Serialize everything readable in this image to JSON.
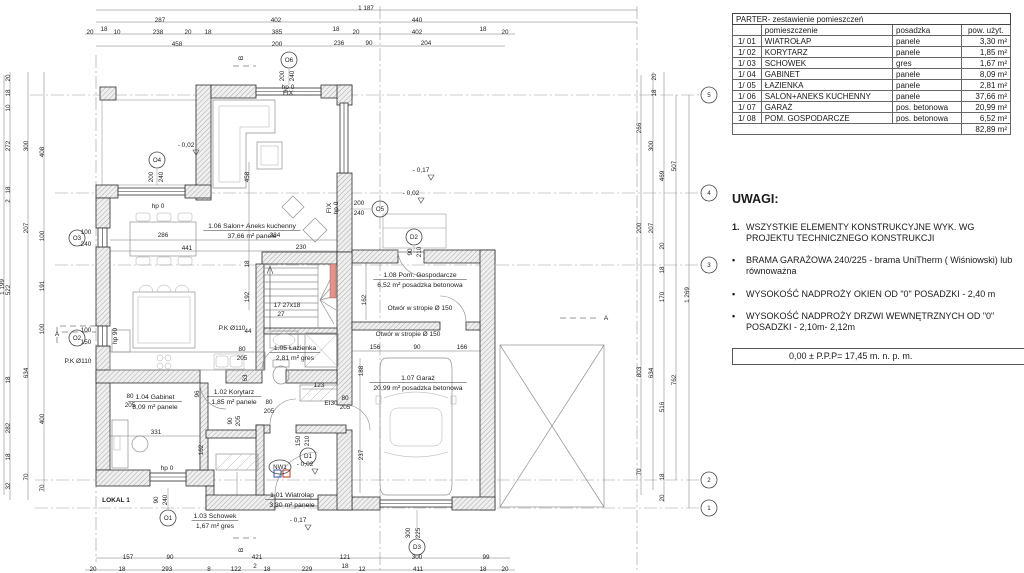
{
  "table": {
    "title": "PARTER- zestawienie pomieszczeń",
    "headers": [
      "",
      "pomieszczenie",
      "posadzka",
      "pow. użyt."
    ],
    "rows": [
      [
        "1/ 01",
        "WIATROŁAP",
        "panele",
        "3,30 m²"
      ],
      [
        "1/ 02",
        "KORYTARZ",
        "panele",
        "1,85 m²"
      ],
      [
        "1/ 03",
        "SCHOWEK",
        "gres",
        "1,67 m²"
      ],
      [
        "1/ 04",
        "GABINET",
        "panele",
        "8,09 m²"
      ],
      [
        "1/ 05",
        "ŁAZIENKA",
        "panele",
        "2,81 m²"
      ],
      [
        "1/ 06",
        "SALON+ANEKS KUCHENNY",
        "panele",
        "37,66 m²"
      ],
      [
        "1/ 07",
        "GARAŻ",
        "pos. betonowa",
        "20,99 m²"
      ],
      [
        "1/ 08",
        "POM. GOSPODARCZE",
        "pos. betonowa",
        "6,52 m²"
      ]
    ],
    "total": "82,89 m²"
  },
  "uwagi": {
    "heading": "UWAGI:",
    "item1_marker": "1.",
    "item1": "WSZYSTKIE ELEMENTY KONSTRUKCYJNE  WYK. WG PROJEKTU TECHNICZNEGO KONSTRUKCJI",
    "bullet_marker": "•",
    "bullets": [
      "BRAMA GARAŻOWA 240/225 - brama UniTherm ( Wiśniowski) lub równoważna",
      "WYSOKOŚĆ NADPROŻY OKIEN OD \"0\" POSADZKI - 2,40 m",
      "WYSOKOŚĆ NADPROŻY DRZWI WEWNĘTRZNYCH OD \"0\" POSADZKI - 2,10m- 2,12m"
    ],
    "level_box": "0,00 ± P.P.P= 17,45 m. n. p. m."
  },
  "plan": {
    "rooms": [
      {
        "num": "1.06",
        "name": "Salon+ Aneks kuchenny",
        "area": "37,66 m²",
        "floor": "panele",
        "x": 252,
        "y": 228
      },
      {
        "num": "1.08",
        "name": "Pom. Gospodarcze",
        "area": "6,52 m²",
        "floor": "posadzka betonowa",
        "x": 420,
        "y": 277
      },
      {
        "num": "1.07",
        "name": "Garaż",
        "area": "20,99 m²",
        "floor": "posadzka betonowa",
        "x": 418,
        "y": 380
      },
      {
        "num": "1.05",
        "name": "Łazienka",
        "area": "2,81 m²",
        "floor": "gres",
        "x": 295,
        "y": 350
      },
      {
        "num": "1.02",
        "name": "Korytarz",
        "area": "1,85 m²",
        "floor": "panele",
        "x": 234,
        "y": 394
      },
      {
        "num": "1.04",
        "name": "Gabinet",
        "area": "8,09 m²",
        "floor": "panele",
        "x": 155,
        "y": 399
      },
      {
        "num": "1.01",
        "name": "Wiatrołap",
        "area": "3,30 m²",
        "floor": "panele",
        "x": 292,
        "y": 497
      },
      {
        "num": "1.03",
        "name": "Schowek",
        "area": "1,67 m²",
        "floor": "gres",
        "x": 215,
        "y": 518
      }
    ],
    "tags": [
      {
        "t": "O6",
        "x": 289,
        "y": 60
      },
      {
        "t": "O4",
        "x": 157,
        "y": 160
      },
      {
        "t": "O3",
        "x": 77,
        "y": 238
      },
      {
        "t": "O2",
        "x": 77,
        "y": 338
      },
      {
        "t": "O1",
        "x": 168,
        "y": 518
      },
      {
        "t": "O5",
        "x": 380,
        "y": 209
      },
      {
        "t": "D2",
        "x": 414,
        "y": 237
      },
      {
        "t": "D1",
        "x": 308,
        "y": 456
      },
      {
        "t": "D3",
        "x": 417,
        "y": 547
      },
      {
        "t": "NW1",
        "x": 280,
        "y": 467,
        "w": 1
      },
      {
        "t": "5",
        "x": 709,
        "y": 95
      },
      {
        "t": "4",
        "x": 709,
        "y": 193
      },
      {
        "t": "3",
        "x": 709,
        "y": 265
      },
      {
        "t": "2",
        "x": 709,
        "y": 480
      },
      {
        "t": "1",
        "x": 709,
        "y": 508
      }
    ],
    "notes": [
      {
        "t": "hp 0",
        "x": 288,
        "y": 89
      },
      {
        "t": "FIX",
        "x": 288,
        "y": 95,
        "s": 4.5
      },
      {
        "t": "hp 0",
        "x": 158,
        "y": 208
      },
      {
        "t": "hp 0",
        "x": 167,
        "y": 470
      },
      {
        "t": "hp 0",
        "x": 338,
        "y": 208,
        "r": -90,
        "s": 5.5
      },
      {
        "t": "FIX",
        "x": 331,
        "y": 208,
        "r": -90,
        "s": 4.5
      },
      {
        "t": "hp 90",
        "x": 117,
        "y": 336,
        "r": -90,
        "s": 5.5
      },
      {
        "t": "- 0,02",
        "x": 186,
        "y": 147
      },
      {
        "t": "- 0,17",
        "x": 421,
        "y": 172
      },
      {
        "t": "- 0,02",
        "x": 411,
        "y": 195
      },
      {
        "t": "- 0,02",
        "x": 305,
        "y": 466
      },
      {
        "t": "- 0,17",
        "x": 298,
        "y": 522
      },
      {
        "t": "P.K Ø110",
        "x": 78,
        "y": 363,
        "s": 6
      },
      {
        "t": "P.K Ø110",
        "x": 232,
        "y": 330,
        "s": 6.5
      },
      {
        "t": "Otwór w stropie Ø 150",
        "x": 420,
        "y": 310
      },
      {
        "t": "Otwór w stropie Ø 150",
        "x": 408,
        "y": 336
      },
      {
        "t": "EI30",
        "x": 331,
        "y": 405
      },
      {
        "t": "17 27x18",
        "x": 287,
        "y": 307
      },
      {
        "t": "27",
        "x": 281,
        "y": 316
      },
      {
        "t": "LOKAL 1",
        "x": 116,
        "y": 502,
        "b": 1,
        "s": 7.5
      },
      {
        "t": "A",
        "x": 57,
        "y": 336,
        "s": 14
      },
      {
        "t": "A",
        "x": 606,
        "y": 320,
        "s": 14
      },
      {
        "t": "B",
        "x": 243,
        "y": 58,
        "s": 14,
        "r": -90
      },
      {
        "t": "B",
        "x": 243,
        "y": 550,
        "s": 14,
        "r": -90
      }
    ],
    "dims": [
      {
        "t": "1 187",
        "x": 366,
        "y": 10
      },
      {
        "t": "287",
        "x": 160,
        "y": 22
      },
      {
        "t": "402",
        "x": 276,
        "y": 22
      },
      {
        "t": "440",
        "x": 417,
        "y": 22
      },
      {
        "t": "20",
        "x": 90,
        "y": 34
      },
      {
        "t": "18",
        "x": 104,
        "y": 31
      },
      {
        "t": "10",
        "x": 117,
        "y": 34
      },
      {
        "t": "238",
        "x": 158,
        "y": 34
      },
      {
        "t": "20",
        "x": 188,
        "y": 34
      },
      {
        "t": "18",
        "x": 208,
        "y": 34
      },
      {
        "t": "385",
        "x": 277,
        "y": 34
      },
      {
        "t": "18",
        "x": 336,
        "y": 31
      },
      {
        "t": "20",
        "x": 356,
        "y": 34
      },
      {
        "t": "402",
        "x": 417,
        "y": 34
      },
      {
        "t": "18",
        "x": 483,
        "y": 31
      },
      {
        "t": "20",
        "x": 505,
        "y": 34
      },
      {
        "t": "458",
        "x": 177,
        "y": 46
      },
      {
        "t": "200",
        "x": 277,
        "y": 46
      },
      {
        "t": "236",
        "x": 339,
        "y": 45
      },
      {
        "t": "90",
        "x": 369,
        "y": 45
      },
      {
        "t": "204",
        "x": 426,
        "y": 45
      },
      {
        "t": "157",
        "x": 128,
        "y": 559
      },
      {
        "t": "90",
        "x": 170,
        "y": 559
      },
      {
        "t": "421",
        "x": 257,
        "y": 559
      },
      {
        "t": "121",
        "x": 345,
        "y": 559
      },
      {
        "t": "300",
        "x": 417,
        "y": 559
      },
      {
        "t": "99",
        "x": 486,
        "y": 559
      },
      {
        "t": "20",
        "x": 93,
        "y": 571
      },
      {
        "t": "18",
        "x": 122,
        "y": 571
      },
      {
        "t": "293",
        "x": 167,
        "y": 571
      },
      {
        "t": "8",
        "x": 209,
        "y": 571
      },
      {
        "t": "122",
        "x": 236,
        "y": 571
      },
      {
        "t": "2",
        "x": 255,
        "y": 568
      },
      {
        "t": "18",
        "x": 267,
        "y": 571
      },
      {
        "t": "229",
        "x": 307,
        "y": 571
      },
      {
        "t": "18",
        "x": 345,
        "y": 568
      },
      {
        "t": "12",
        "x": 362,
        "y": 571
      },
      {
        "t": "411",
        "x": 418,
        "y": 571
      },
      {
        "t": "18",
        "x": 483,
        "y": 571
      },
      {
        "t": "20",
        "x": 505,
        "y": 571
      },
      {
        "t": "1 199",
        "x": 4,
        "y": 287,
        "r": -90
      },
      {
        "t": "20",
        "x": 10,
        "y": 78,
        "r": -90
      },
      {
        "t": "18",
        "x": 10,
        "y": 93,
        "r": -90
      },
      {
        "t": "10",
        "x": 10,
        "y": 108,
        "r": -90
      },
      {
        "t": "272",
        "x": 10,
        "y": 146,
        "r": -90
      },
      {
        "t": "18",
        "x": 10,
        "y": 190,
        "r": -90
      },
      {
        "t": "2",
        "x": 10,
        "y": 201,
        "r": -90
      },
      {
        "t": "522",
        "x": 10,
        "y": 290,
        "r": -90
      },
      {
        "t": "18",
        "x": 10,
        "y": 380,
        "r": -90
      },
      {
        "t": "282",
        "x": 10,
        "y": 428,
        "r": -90
      },
      {
        "t": "18",
        "x": 10,
        "y": 457,
        "r": -90
      },
      {
        "t": "32",
        "x": 10,
        "y": 486,
        "r": -90
      },
      {
        "t": "300",
        "x": 28,
        "y": 146,
        "r": -90
      },
      {
        "t": "207",
        "x": 28,
        "y": 228,
        "r": -90
      },
      {
        "t": "634",
        "x": 28,
        "y": 373,
        "r": -90
      },
      {
        "t": "70",
        "x": 28,
        "y": 477,
        "r": -90
      },
      {
        "t": "408",
        "x": 44,
        "y": 152,
        "r": -90
      },
      {
        "t": "100",
        "x": 44,
        "y": 236,
        "r": -90
      },
      {
        "t": "191",
        "x": 44,
        "y": 286,
        "r": -90
      },
      {
        "t": "100",
        "x": 44,
        "y": 329,
        "r": -90
      },
      {
        "t": "400",
        "x": 44,
        "y": 419,
        "r": -90
      },
      {
        "t": "70",
        "x": 44,
        "y": 488,
        "r": -90
      },
      {
        "t": "266",
        "x": 641,
        "y": 128,
        "r": -90
      },
      {
        "t": "200",
        "x": 641,
        "y": 228,
        "r": -90
      },
      {
        "t": "803",
        "x": 641,
        "y": 372,
        "r": -90
      },
      {
        "t": "70",
        "x": 641,
        "y": 472,
        "r": -90
      },
      {
        "t": "300",
        "x": 653,
        "y": 146,
        "r": -90
      },
      {
        "t": "207",
        "x": 653,
        "y": 228,
        "r": -90
      },
      {
        "t": "634",
        "x": 653,
        "y": 373,
        "r": -90
      },
      {
        "t": "20",
        "x": 656,
        "y": 77,
        "r": -90
      },
      {
        "t": "18",
        "x": 656,
        "y": 93,
        "r": -90
      },
      {
        "t": "469",
        "x": 664,
        "y": 176,
        "r": -90
      },
      {
        "t": "20",
        "x": 664,
        "y": 246,
        "r": -90
      },
      {
        "t": "18",
        "x": 664,
        "y": 270,
        "r": -90
      },
      {
        "t": "170",
        "x": 664,
        "y": 297,
        "r": -90
      },
      {
        "t": "516",
        "x": 664,
        "y": 407,
        "r": -90
      },
      {
        "t": "18",
        "x": 664,
        "y": 477,
        "r": -90
      },
      {
        "t": "20",
        "x": 664,
        "y": 498,
        "r": -90
      },
      {
        "t": "507",
        "x": 676,
        "y": 166,
        "r": -90
      },
      {
        "t": "762",
        "x": 676,
        "y": 380,
        "r": -90
      },
      {
        "t": "1 269",
        "x": 689,
        "y": 295,
        "r": -90
      },
      {
        "t": "286",
        "x": 163,
        "y": 237
      },
      {
        "t": "441",
        "x": 187,
        "y": 250
      },
      {
        "t": "384",
        "x": 275,
        "y": 237
      },
      {
        "t": "230",
        "x": 301,
        "y": 249
      },
      {
        "t": "458",
        "x": 249,
        "y": 177,
        "r": -90
      },
      {
        "t": "18",
        "x": 249,
        "y": 264,
        "r": -90
      },
      {
        "t": "192",
        "x": 249,
        "y": 297,
        "r": -90
      },
      {
        "t": "162",
        "x": 366,
        "y": 300,
        "r": -90
      },
      {
        "t": "156",
        "x": 375,
        "y": 349
      },
      {
        "t": "90",
        "x": 417,
        "y": 349
      },
      {
        "t": "166",
        "x": 462,
        "y": 349
      },
      {
        "t": "188",
        "x": 363,
        "y": 371,
        "r": -90
      },
      {
        "t": "237",
        "x": 363,
        "y": 455,
        "r": -90
      },
      {
        "t": "96",
        "x": 199,
        "y": 394,
        "r": -90
      },
      {
        "t": "162",
        "x": 203,
        "y": 450,
        "r": -90
      },
      {
        "t": "331",
        "x": 156,
        "y": 434
      },
      {
        "t": "123",
        "x": 319,
        "y": 387
      },
      {
        "t": "63",
        "x": 247,
        "y": 378,
        "r": -90
      },
      {
        "t": "44",
        "x": 248,
        "y": 333
      },
      {
        "t": "200",
        "x": 153,
        "y": 177,
        "r": -90
      },
      {
        "t": "240",
        "x": 163,
        "y": 177,
        "r": -90
      },
      {
        "t": "200",
        "x": 284,
        "y": 76,
        "r": -90
      },
      {
        "t": "240",
        "x": 294,
        "y": 76,
        "r": -90
      },
      {
        "t": "200",
        "x": 359,
        "y": 205
      },
      {
        "t": "240",
        "x": 359,
        "y": 215
      },
      {
        "t": "90",
        "x": 412,
        "y": 252,
        "r": -90
      },
      {
        "t": "210",
        "x": 421,
        "y": 252,
        "r": -90
      },
      {
        "t": "150",
        "x": 300,
        "y": 441,
        "r": -90
      },
      {
        "t": "210",
        "x": 309,
        "y": 441,
        "r": -90
      },
      {
        "t": "300",
        "x": 410,
        "y": 533,
        "r": -90
      },
      {
        "t": "225",
        "x": 420,
        "y": 533,
        "r": -90
      },
      {
        "t": "90",
        "x": 158,
        "y": 500,
        "r": -90
      },
      {
        "t": "240",
        "x": 167,
        "y": 500,
        "r": -90
      },
      {
        "t": "80",
        "x": 242,
        "y": 351
      },
      {
        "t": "205",
        "x": 242,
        "y": 360
      },
      {
        "t": "80",
        "x": 130,
        "y": 398
      },
      {
        "t": "205",
        "x": 130,
        "y": 407
      },
      {
        "t": "80",
        "x": 269,
        "y": 404
      },
      {
        "t": "205",
        "x": 269,
        "y": 413
      },
      {
        "t": "80",
        "x": 345,
        "y": 400
      },
      {
        "t": "205",
        "x": 345,
        "y": 409
      },
      {
        "t": "90",
        "x": 232,
        "y": 421,
        "r": -90
      },
      {
        "t": "205",
        "x": 240,
        "y": 421,
        "r": -90
      },
      {
        "t": "100",
        "x": 86,
        "y": 234
      },
      {
        "t": "240",
        "x": 86,
        "y": 246
      },
      {
        "t": "100",
        "x": 86,
        "y": 332
      },
      {
        "t": "150",
        "x": 86,
        "y": 344
      }
    ]
  },
  "colors": {
    "accent_red": "#e0948c",
    "marker_blue": "#3355aa",
    "marker_red": "#bb3322"
  }
}
